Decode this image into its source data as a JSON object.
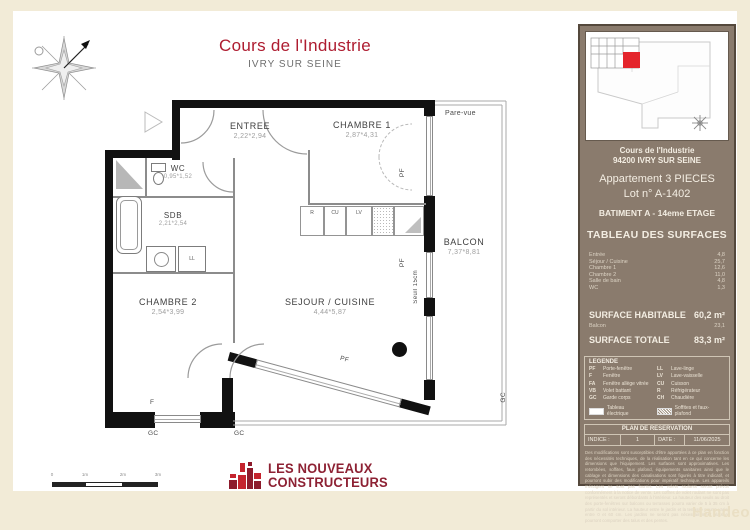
{
  "header": {
    "title": "Cours de l'Industrie",
    "subtitle": "IVRY SUR SEINE"
  },
  "plan": {
    "rooms": [
      {
        "name": "ENTREE",
        "dims": "2,22*2,94"
      },
      {
        "name": "CHAMBRE 1",
        "dims": "2,87*4,31"
      },
      {
        "name": "WC",
        "dims": "0,95*1,52"
      },
      {
        "name": "SDB",
        "dims": "2,21*2,54"
      },
      {
        "name": "CHAMBRE 2",
        "dims": "2,54*3,99"
      },
      {
        "name": "SEJOUR / CUISINE",
        "dims": "4,44*5,87"
      },
      {
        "name": "BALCON",
        "dims": "7,37*8,81"
      }
    ],
    "labels": {
      "pare_vue": "Pare-vue",
      "seuil": "Seuil 15cm",
      "pf": "PF",
      "f": "F",
      "gc": "GC",
      "ll": "LL",
      "lv": "LV",
      "cu": "CU",
      "r": "R"
    },
    "scale": [
      "0",
      "1m",
      "2m",
      "3m"
    ]
  },
  "sidebar": {
    "project": "Cours de l'Industrie",
    "city": "94200 IVRY SUR SEINE",
    "apartment_type": "Appartement  3 PIECES",
    "lot": "Lot n° A-1402",
    "batiment": "BATIMENT   A - 14eme ETAGE",
    "surfaces_title": "TABLEAU DES SURFACES",
    "surfaces": [
      {
        "label": "Entrée",
        "value": "4,8"
      },
      {
        "label": "Séjour / Cuisine",
        "value": "25,7"
      },
      {
        "label": "Chambre 1",
        "value": "12,6"
      },
      {
        "label": "Chambre 2",
        "value": "11,0"
      },
      {
        "label": "Salle de bain",
        "value": "4,8"
      },
      {
        "label": "WC",
        "value": "1,3"
      }
    ],
    "surface_habitable_label": "SURFACE HABITABLE",
    "surface_habitable_value": "60,2 m²",
    "balcon_label": "Balcon",
    "balcon_value": "23,1",
    "surface_totale_label": "SURFACE TOTALE",
    "surface_totale_value": "83,3 m²",
    "legende": {
      "title": "LEGENDE",
      "left": [
        {
          "abbr": "PF",
          "label": "Porte-fenêtre"
        },
        {
          "abbr": "F",
          "label": "Fenêtre"
        },
        {
          "abbr": "FA",
          "label": "Fenêtre allège vitrée"
        },
        {
          "abbr": "VB",
          "label": "Volet battant"
        },
        {
          "abbr": "GC",
          "label": "Garde corps"
        }
      ],
      "right": [
        {
          "abbr": "LL",
          "label": "Lave-linge"
        },
        {
          "abbr": "LV",
          "label": "Lave-vaisselle"
        },
        {
          "abbr": "CU",
          "label": "Cuisson"
        },
        {
          "abbr": "R",
          "label": "Réfrigérateur"
        },
        {
          "abbr": "CH",
          "label": "Chaudière"
        }
      ],
      "tableau_electrique": "Tableau électrique",
      "soffites": "Soffites et faux-plafond"
    },
    "reservation": {
      "title": "PLAN DE RESERVATION",
      "indice_label": "INDICE :",
      "indice_value": "1",
      "date_label": "DATE :",
      "date_value": "11/06/2025"
    },
    "disclaimer": "Des modifications sont susceptibles d'être apportées à ce plan en fonction des nécessités techniques, de la réalisation tant en ce qui concerne les dimensions que l'équipement. Les surfaces sont approximatives. Les retombées, soffites, faux plafond, équipements sanitaires ainsi que le cablage et dimensions des canalisations sont figurés à titre indicatif, et pourront subir des modifications pour impératif technique. Les appareils ménagers ne sont pas fournis. Les volets roulants seront prévus conformément à la notice de vente. Les coffres de volet roulant ne sont pas représentés et seront débordants à l'intérieur. La hauteur des seuils au droit des porte-fenêtres sur balcons ou terrasses pourra varier de 5 à 35 cm à partir du sol intérieur. La hauteur entre le jardin et la terrasse pourra varier entre 0 et 60 cm. Les jardins ne seront pas nécessairement plats et pourront comporter des talus et des pentes."
  },
  "footer": {
    "logo_line1": "LES NOUVEAUX",
    "logo_line2": "CONSTRUCTEURS",
    "watermark": "Handeo"
  }
}
